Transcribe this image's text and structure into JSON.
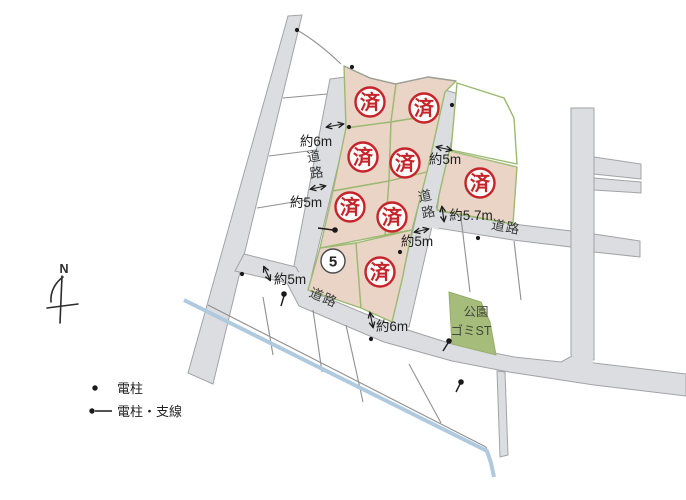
{
  "map_labels": {
    "north": "N",
    "road": "道路",
    "sold_stamp": "済",
    "available_lot_number": "5",
    "park": "公園",
    "garbage_station": "ゴミST"
  },
  "measurements": {
    "left_road_top": "約6m",
    "left_road_mid": "約5m",
    "left_road_bottom": "約5m",
    "bottom_road": "約6m",
    "right_road_top": "約5m",
    "right_road_mid": "約5m",
    "east_road_width": "約5.7m"
  },
  "legend": {
    "items": [
      {
        "symbol": "utility-pole-dot",
        "label": "電柱"
      },
      {
        "symbol": "utility-pole-wire",
        "label": "電柱・支線"
      }
    ]
  },
  "colors": {
    "sold_lot_fill": "#e9d4c6",
    "lot_border_green": "#9cb972",
    "road_fill": "#dcdde0",
    "road_border": "#a2a3a7",
    "parcel_line": "#8f9092",
    "park_fill": "#a6bc7b",
    "water_blue": "#afc9de",
    "stamp_red": "#c5242a"
  }
}
